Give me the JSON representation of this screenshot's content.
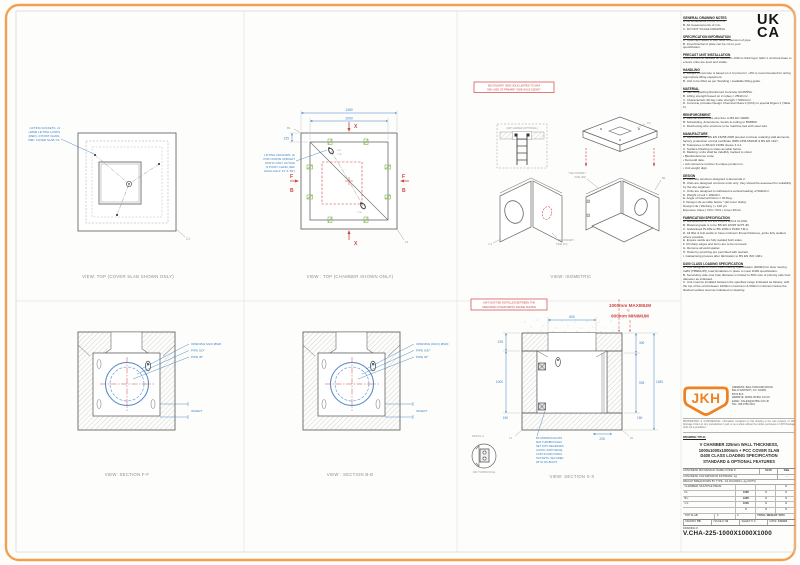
{
  "colors": {
    "accent_orange": "#F29A3F",
    "annotation_blue": "#3F81C2",
    "marking_red": "#CF4343",
    "clamp_green": "#7DB54A"
  },
  "ukca": {
    "line1": "UK",
    "line2": "CA"
  },
  "notes": {
    "sections": [
      {
        "title": "GENERAL DRAWING NOTES",
        "lines": [
          "A.  All dimensions in mm U.O.S.",
          "B.  All measurements of mm.",
          "C.  DO NOT SCALE DRAWING."
        ]
      },
      {
        "title": "SPECIFICATION INFORMATION",
        "lines": [
          "A.  Openings raised to suit outer dimension of pipe.",
          "B.  Inner/Internal of plate can be cut to your specification."
        ]
      },
      {
        "title": "PRECAST UNIT INSTALLATION",
        "lines": [
          "Units should be bedded on minimum 100mm thick layer GEN 1 concrete base to ensure units are level and stable."
        ]
      },
      {
        "title": "HANDLING",
        "lines": [
          "A.  Weight of concrete is based on 2.4 tonne/m³, +5% is recommended for sizing appropriate lifting equipment.",
          "B.  Unit to be lifted as per Standing / available lifting guide."
        ]
      },
      {
        "title": "MATERIAL",
        "lines": [
          "A.  Self compacting Reinforced Concrete SC45/55A.",
          "B.  Lifting strength based on 2 cubes = 25N/mm².",
          "C.  Characteristic 28 day cube strength = 50N/mm².",
          "D.  Concrete provides Design Chemical Class 4 (DC4) to special Digest 1 (Table F)."
        ]
      },
      {
        "title": "REINFORCEMENT",
        "lines": [
          "A.  Reinforcement fibre structure to BS EN 10080.",
          "B.  Scheduling, dimensions, bends & cutting to BS8666.",
          "C.  Reinforcing wire structure to be machine tied with steel wire."
        ]
      },
      {
        "title": "MANUFACTURE",
        "lines": [
          "A.  Manufacture to BS EN 15258:2008 precast concrete retaining wall elements, factory production control certificate 0086-CPR-652045 & BS EN 1917.",
          "B.  Tolerances to BS EN 13369 clause 4.3.1.",
          "C.  Surface finishing to class as table below.",
          "D.  Marking: units shall be indelibly marked to show:",
          "•  Block/reference code.",
          "•  Demould date.",
          "•  Job reference number & unique product no.",
          "•  Unit weight digit."
        ]
      },
      {
        "title": "DESIGN",
        "lines": [
          "A.  Concrete structure designed to Eurocode 2.",
          "B.  Units are designed concrete units only, they should be assessed for suitability by the site engineer.",
          "C.  Units are designed to withstand a vertical loading of 50kN/m².",
          "D.  Weight of soil = 18kN/m³.",
          "E.  Angle of internal friction = 30 Deg.",
          "F.  Design Life as table below * (all cover slabs).",
          "Design Life  |  Working  |  + 100 yrs",
          "Exposure Class  |  XC3 / XD1  |  Cover 30mm"
        ]
      },
      {
        "title": "FABRICATION SPECIFICATION",
        "lines": [
          "A.  Manufacture to BS EN 1090-2 EXC2 CLASS.",
          "B.  Material grade is to be BS EN 10025 S275 JR.",
          "C.  Galvanised PLATE to BS 1090-2 PARA T.B-4.",
          "D.  All fillet & butt welds to have minimum throat thickness, joints fully welded where possible.",
          "E.  Ensure welds are fully welded both sides.",
          "F.  All sharp edges and burrs are to be removed.",
          "G.  Remove all weld spatter.",
          "H.  Holes by punching are permitted with warrant.",
          "I.  Galvanising process after fabrication to BS EN ISO 1461."
        ]
      },
      {
        "title": "D400 CLASS LOADING SPECIFICATION",
        "lines": [
          "A.  Unit designed to D400 class loading specification (400kN) for slow moving traffic (HB901/45), load limitations in place to meet D400 specification.",
          "B.  Secondary side max hole diameter is limited to 50% size of primary side host diameter as indicated.",
          "C.  Unit must be installed between the specified range indicated as follows, with the top of the unit between 1000mm maximum & 600mm minimum below the finished surface level as indicated on drawing."
        ]
      }
    ]
  },
  "views": {
    "top_cover": {
      "caption": "VIEW: TOP (COVER SLAB SHOWN ONLY)",
      "label": "C1",
      "note": [
        "LIFTING SOCKETS, x3",
        "+WIRE LIFTING LOOPS",
        "(RED), 3 POINT CHAIN,",
        "REF: COVER SLAB 'C1'"
      ]
    },
    "top_chamber": {
      "caption": "VIEW : TOP (CHAMBER SHOWN ONLY)",
      "dim_outer": "1450",
      "dim_inner": "1000",
      "dim_wall": "225",
      "sec_x": "X",
      "sec_f": "F",
      "sec_b": "B",
      "corner_tl": "B1",
      "corner_br": "F1",
      "lift": "LIFT",
      "ctr": "CTR",
      "note": [
        "LIFTING ANCHORS, 3x",
        "FOR ONSITE UPRIGHT",
        "STATIC ONLY LIFTING",
        "(3 POINT CHAIN, REF",
        "EACH HALF 'F1' & 'B1')"
      ]
    },
    "isometric": {
      "caption": "VIEW: ISOMETRIC",
      "ladder": "GRP LADDER (OPTIONAL)",
      "c1": "C1",
      "b1": "B1",
      "f1": "F1",
      "warning": [
        "SECONDARY SIDE HOLE LIMITED TO MAX",
        "50% SIZE OF PRIMARY SIDE HOLE SIZING*"
      ],
      "sec_b": [
        "* SECONDARY",
        "SIDE (B1)"
      ],
      "sec_f": [
        "* SECONDARY",
        "SIDE (F1)"
      ]
    },
    "section_ff": {
      "caption": "VIEW: SECTION F-F",
      "l1": "OPENING MAX Ø620",
      "l2": "PIPE OD*",
      "l3": "PIPE ID*",
      "l4": "INVERT"
    },
    "section_bb": {
      "caption": "VIEW : SECTION B-B",
      "l1": "OPENING (MAX) Ø620",
      "l2": "PIPE O/D*",
      "l3": "PIPE ID*",
      "l4": "INVERT"
    },
    "section_xx": {
      "caption": "VIEW: SECTION X-X",
      "warning": [
        "UNIT MUST BE INSTALLED BETWEEN THE",
        "SPECIFIED COVER DEPTH RANGE SHOWN"
      ],
      "depth_max": "1000mm MAXIMUM",
      "depth_to": "TO",
      "depth_min": "600mm MINIMUM",
      "dims": {
        "top": "600",
        "wall": "225",
        "left": "1000",
        "r1": "300",
        "r2": "925",
        "r3": "1450",
        "b1": "150",
        "b2": "225",
        "b3": "150",
        "fl": "F1",
        "bl": "B1"
      },
      "detail": "DETAIL A",
      "detail_cap": "M20 TURNBUCKLE",
      "note": [
        "BT-SPANNSCHLOSS",
        "M20 TURNBUCKLES",
        "SET INTO RECESSES",
        "ALONG JOINT EDGE,",
        "CAST-IN M20 FIXING",
        "SOCKETS, SECURED",
        "WITH S/S BOLTS"
      ]
    }
  },
  "title_block": {
    "logo": "JKH",
    "company": [
      "ADDRESS:  BALLYMACARN ROAD,",
      "BALLYNAHINCH, CO. DOWN,",
      "BT24 8LS",
      "WEBSITE:  WWW.JKHDU.CO.UK",
      "EMAIL:  SALES@JKHDU.CO.UK",
      "TEL:  028 9756 2311"
    ],
    "proprietary": "PROPRIETARY & CONFIDENTIAL:  Information contained on this drawing is the sole property of JKH Drainage Units Ltd. Any reproduction in part or as a whole without the written permission of JKH Drainage Units Ltd is prohibited.",
    "title_label": "DRAWING TITLE:",
    "title_lines": [
      "V CHAMBER 225mm WALL THICKNESS,",
      "1000x1000x1000mm + PCC COVER SLAB",
      "D400 CLASS LOADING SPECIFICATION",
      "STANDARD & OPTIONAL FEATURES"
    ],
    "mix_label": "CONCRETE MIX DESIGN: NAME /CODE #:",
    "mix_v1": "SC45",
    "mix_v2": "DBa",
    "co2_label": "CONCRETE CO2 EMISSION ESTIMATE: kg:",
    "co2_v": "--",
    "weight_label": "WEIGHT BREAKDOWN BY TYPE - AS FIGURED (~kg UNITS)",
    "weight_table": [
      [
        "CHAMBER, MULTIPLE PIECE:",
        "",
        "",
        "0"
      ],
      [
        "F1:",
        "1985",
        "0",
        "0"
      ],
      [
        "B1:",
        "1985",
        "0",
        "0"
      ],
      [
        "C1:",
        "1900",
        "0",
        "0"
      ],
      [
        "",
        "0",
        "0",
        "0"
      ]
    ],
    "total_row": {
      "c0": "TOP SLAB:",
      "c1": "0",
      "c2": "0",
      "label": "TOTAL WEIGHT:",
      "value": "5870"
    },
    "info": [
      {
        "l": "DRAWN:",
        "v": "PK"
      },
      {
        "l": "ISSUE #:",
        "v": "01"
      },
      {
        "l": "SHEET #:",
        "v": "1"
      },
      {
        "l": "DATE:",
        "v": "120124"
      }
    ],
    "number_label": "DRAWING #:",
    "number": "V.CHA-225-1000X1000X1000"
  }
}
